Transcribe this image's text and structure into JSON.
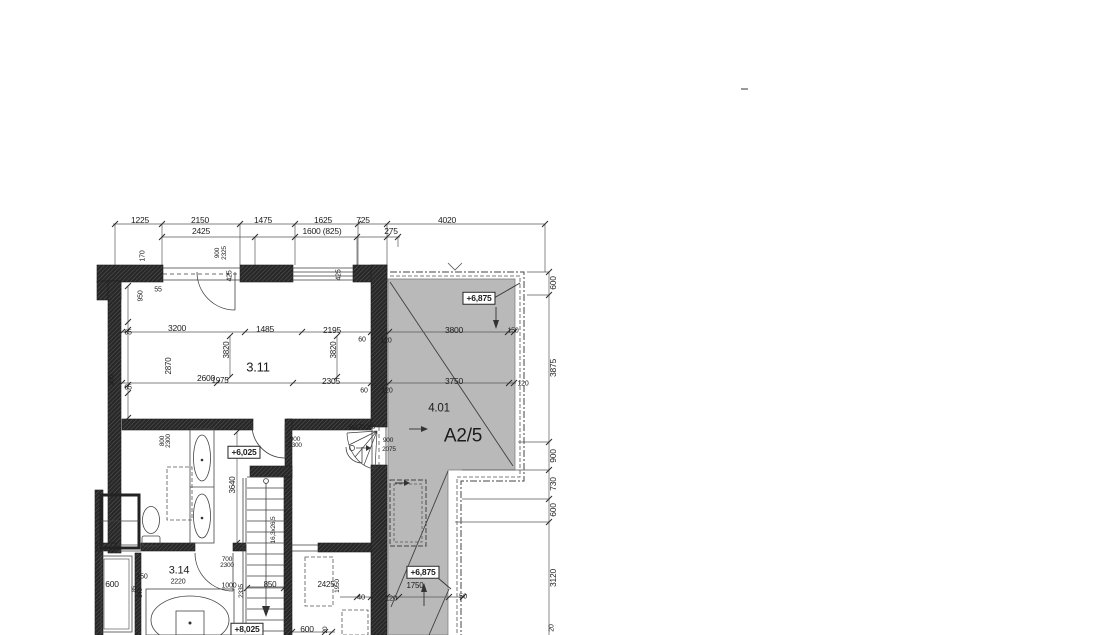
{
  "meta": {
    "drawing_type": "architectural floor plan detail (CAD)",
    "background": "#ffffff",
    "line_color": "#3f3f3f",
    "wall_color": "#282828",
    "terrace_fill": "#b9b9b9"
  },
  "plan": {
    "unit_label": "A2/5",
    "rooms": [
      {
        "number": "3.11"
      },
      {
        "number": "3.14"
      },
      {
        "number": "4.01"
      }
    ],
    "elevation_markers": [
      "+6,875",
      "+6,025",
      "+6,875",
      "+8,025"
    ],
    "stair_annotations": [
      "5x170/260",
      "16,3x26,5"
    ],
    "door_sizes": [
      "900/2300",
      "800/2300",
      "700/2300",
      "900/2075",
      "900/2325"
    ],
    "dimension_chains": {
      "top_row_1": [
        "1225",
        "2150",
        "1475",
        "1625",
        "725",
        "4020"
      ],
      "top_row_2": [
        "2425",
        "1600 (825)",
        "275"
      ],
      "right_column": [
        "600",
        "3875",
        "900",
        "730",
        "600",
        "3120",
        "20"
      ],
      "interior_row_upper": [
        "3200",
        "1485",
        "2195"
      ],
      "interior_row_lower": [
        "2600",
        "1975",
        "2305"
      ],
      "terrace": [
        "3800",
        "150",
        "3750",
        "120",
        "120",
        "120"
      ]
    }
  },
  "labels": [
    {
      "t": "1225",
      "x": 140,
      "y": 220,
      "s": 8.5
    },
    {
      "t": "2150",
      "x": 200,
      "y": 220,
      "s": 8.5
    },
    {
      "t": "1475",
      "x": 263,
      "y": 220,
      "s": 8.5
    },
    {
      "t": "1625",
      "x": 323,
      "y": 220,
      "s": 8.5
    },
    {
      "t": "725",
      "x": 363,
      "y": 220,
      "s": 8.5
    },
    {
      "t": "4020",
      "x": 447,
      "y": 220,
      "s": 8.5
    },
    {
      "t": "2425",
      "x": 201,
      "y": 231,
      "s": 8.5
    },
    {
      "t": "1600 (825)",
      "x": 322,
      "y": 231,
      "s": 8.5
    },
    {
      "t": "275",
      "x": 391,
      "y": 231,
      "s": 8.5
    },
    {
      "t": "170",
      "x": 143,
      "y": 256,
      "s": 7,
      "r": -90
    },
    {
      "t": "900",
      "x": 218,
      "y": 253,
      "s": 6.5,
      "r": -90,
      "n": "door-size"
    },
    {
      "t": "2325",
      "x": 225,
      "y": 253,
      "s": 6.5,
      "r": -90,
      "n": "door-size"
    },
    {
      "t": "425",
      "x": 230,
      "y": 276,
      "s": 7,
      "r": -90
    },
    {
      "t": "425",
      "x": 339,
      "y": 275,
      "s": 7,
      "r": -90
    },
    {
      "t": "600",
      "x": 553,
      "y": 283,
      "s": 8.5,
      "r": -90
    },
    {
      "t": "3875",
      "x": 553,
      "y": 368,
      "s": 8.5,
      "r": -90
    },
    {
      "t": "900",
      "x": 553,
      "y": 456,
      "s": 8.5,
      "r": -90
    },
    {
      "t": "730",
      "x": 553,
      "y": 484,
      "s": 8.5,
      "r": -90
    },
    {
      "t": "600",
      "x": 553,
      "y": 510,
      "s": 8.5,
      "r": -90
    },
    {
      "t": "3120",
      "x": 553,
      "y": 578,
      "s": 8.5,
      "r": -90
    },
    {
      "t": "20",
      "x": 552,
      "y": 628,
      "s": 7,
      "r": -90
    },
    {
      "t": "950",
      "x": 141,
      "y": 296,
      "s": 7,
      "r": -90
    },
    {
      "t": "55",
      "x": 158,
      "y": 290,
      "s": 7
    },
    {
      "t": "65",
      "x": 128,
      "y": 333,
      "s": 7
    },
    {
      "t": "2870",
      "x": 169,
      "y": 366,
      "s": 8,
      "r": -90
    },
    {
      "t": "65",
      "x": 128,
      "y": 388,
      "s": 7
    },
    {
      "t": "300",
      "x": 112,
      "y": 380,
      "s": 7,
      "r": -90
    },
    {
      "t": "3200",
      "x": 177,
      "y": 328,
      "s": 8.5
    },
    {
      "t": "1485",
      "x": 265,
      "y": 329,
      "s": 8.5
    },
    {
      "t": "2195",
      "x": 332,
      "y": 330,
      "s": 8.5
    },
    {
      "t": "3820",
      "x": 227,
      "y": 350,
      "s": 8,
      "r": -90
    },
    {
      "t": "3820",
      "x": 334,
      "y": 350,
      "s": 8,
      "r": -90
    },
    {
      "t": "60",
      "x": 362,
      "y": 340,
      "s": 7
    },
    {
      "t": "60",
      "x": 364,
      "y": 391,
      "s": 7
    },
    {
      "t": "2600",
      "x": 206,
      "y": 378,
      "s": 8.5
    },
    {
      "t": "1975",
      "x": 220,
      "y": 381,
      "s": 8
    },
    {
      "t": "2305",
      "x": 331,
      "y": 381,
      "s": 8.5
    },
    {
      "t": "3800",
      "x": 454,
      "y": 330,
      "s": 8.5
    },
    {
      "t": "150",
      "x": 513,
      "y": 331,
      "s": 7
    },
    {
      "t": "120",
      "x": 386,
      "y": 341,
      "s": 7
    },
    {
      "t": "3750",
      "x": 454,
      "y": 381,
      "s": 8.5
    },
    {
      "t": "120",
      "x": 387,
      "y": 391,
      "s": 7
    },
    {
      "t": "120",
      "x": 523,
      "y": 384,
      "s": 7
    },
    {
      "t": "3.11",
      "x": 258,
      "y": 367,
      "s": 13,
      "n": "room-label"
    },
    {
      "t": "4.01",
      "x": 439,
      "y": 409,
      "s": 11.5,
      "n": "room-label"
    },
    {
      "t": "A2/5",
      "x": 463,
      "y": 436,
      "s": 19,
      "n": "unit-label"
    },
    {
      "t": "3.14",
      "x": 179,
      "y": 571,
      "s": 11,
      "n": "room-label"
    },
    {
      "t": "2220",
      "x": 178,
      "y": 582,
      "s": 7
    },
    {
      "t": "+6,875",
      "x": 479,
      "y": 298,
      "s": 8.5,
      "b": true,
      "n": "elevation-marker"
    },
    {
      "t": "+6,025",
      "x": 244,
      "y": 452,
      "s": 8.5,
      "b": true,
      "n": "elevation-marker"
    },
    {
      "t": "+6,875",
      "x": 423,
      "y": 572,
      "s": 8.5,
      "b": true,
      "n": "elevation-marker"
    },
    {
      "t": "+8,025",
      "x": 247,
      "y": 629,
      "s": 8.5,
      "b": true,
      "n": "elevation-marker"
    },
    {
      "t": "900",
      "x": 295,
      "y": 440,
      "s": 6.5,
      "n": "door-size"
    },
    {
      "t": "2300",
      "x": 295,
      "y": 446,
      "s": 6.5,
      "n": "door-size"
    },
    {
      "t": "800",
      "x": 163,
      "y": 441,
      "s": 6.5,
      "r": -90,
      "n": "door-size"
    },
    {
      "t": "2300",
      "x": 169,
      "y": 441,
      "s": 6.5,
      "r": -90,
      "n": "door-size"
    },
    {
      "t": "700",
      "x": 227,
      "y": 560,
      "s": 6.5,
      "n": "door-size"
    },
    {
      "t": "2300",
      "x": 227,
      "y": 566,
      "s": 6.5,
      "n": "door-size"
    },
    {
      "t": "900",
      "x": 388,
      "y": 441,
      "s": 6.5,
      "n": "door-size"
    },
    {
      "t": "2075",
      "x": 389,
      "y": 450,
      "s": 6.5,
      "n": "door-size"
    },
    {
      "t": "5x170/260",
      "x": 362,
      "y": 428,
      "s": 6,
      "n": "stair-annotation"
    },
    {
      "t": "16,3x26,5",
      "x": 274,
      "y": 530,
      "s": 6.5,
      "r": -90,
      "n": "stair-annotation"
    },
    {
      "t": "850",
      "x": 270,
      "y": 585,
      "s": 8
    },
    {
      "t": "3640",
      "x": 233,
      "y": 485,
      "s": 8,
      "r": -90
    },
    {
      "t": "1750",
      "x": 415,
      "y": 586,
      "s": 8
    },
    {
      "t": "40",
      "x": 361,
      "y": 597,
      "s": 7.5
    },
    {
      "t": "120",
      "x": 391,
      "y": 598,
      "s": 7.5
    },
    {
      "t": "50",
      "x": 463,
      "y": 596,
      "s": 7.5
    },
    {
      "t": "2425",
      "x": 326,
      "y": 585,
      "s": 8
    },
    {
      "t": "1950",
      "x": 338,
      "y": 586,
      "s": 6.5,
      "r": -90
    },
    {
      "t": "600",
      "x": 112,
      "y": 584,
      "s": 8.5
    },
    {
      "t": "150",
      "x": 142,
      "y": 577,
      "s": 7
    },
    {
      "t": "85",
      "x": 135,
      "y": 589,
      "s": 6,
      "r": -90
    },
    {
      "t": "340",
      "x": 141,
      "y": 593,
      "s": 6,
      "r": -90
    },
    {
      "t": "1000",
      "x": 229,
      "y": 586,
      "s": 7
    },
    {
      "t": "2335",
      "x": 242,
      "y": 591,
      "s": 6.5,
      "r": -90
    },
    {
      "t": "600",
      "x": 307,
      "y": 629,
      "s": 8.5
    },
    {
      "t": "20",
      "x": 326,
      "y": 630,
      "s": 6.5,
      "r": -90
    }
  ]
}
